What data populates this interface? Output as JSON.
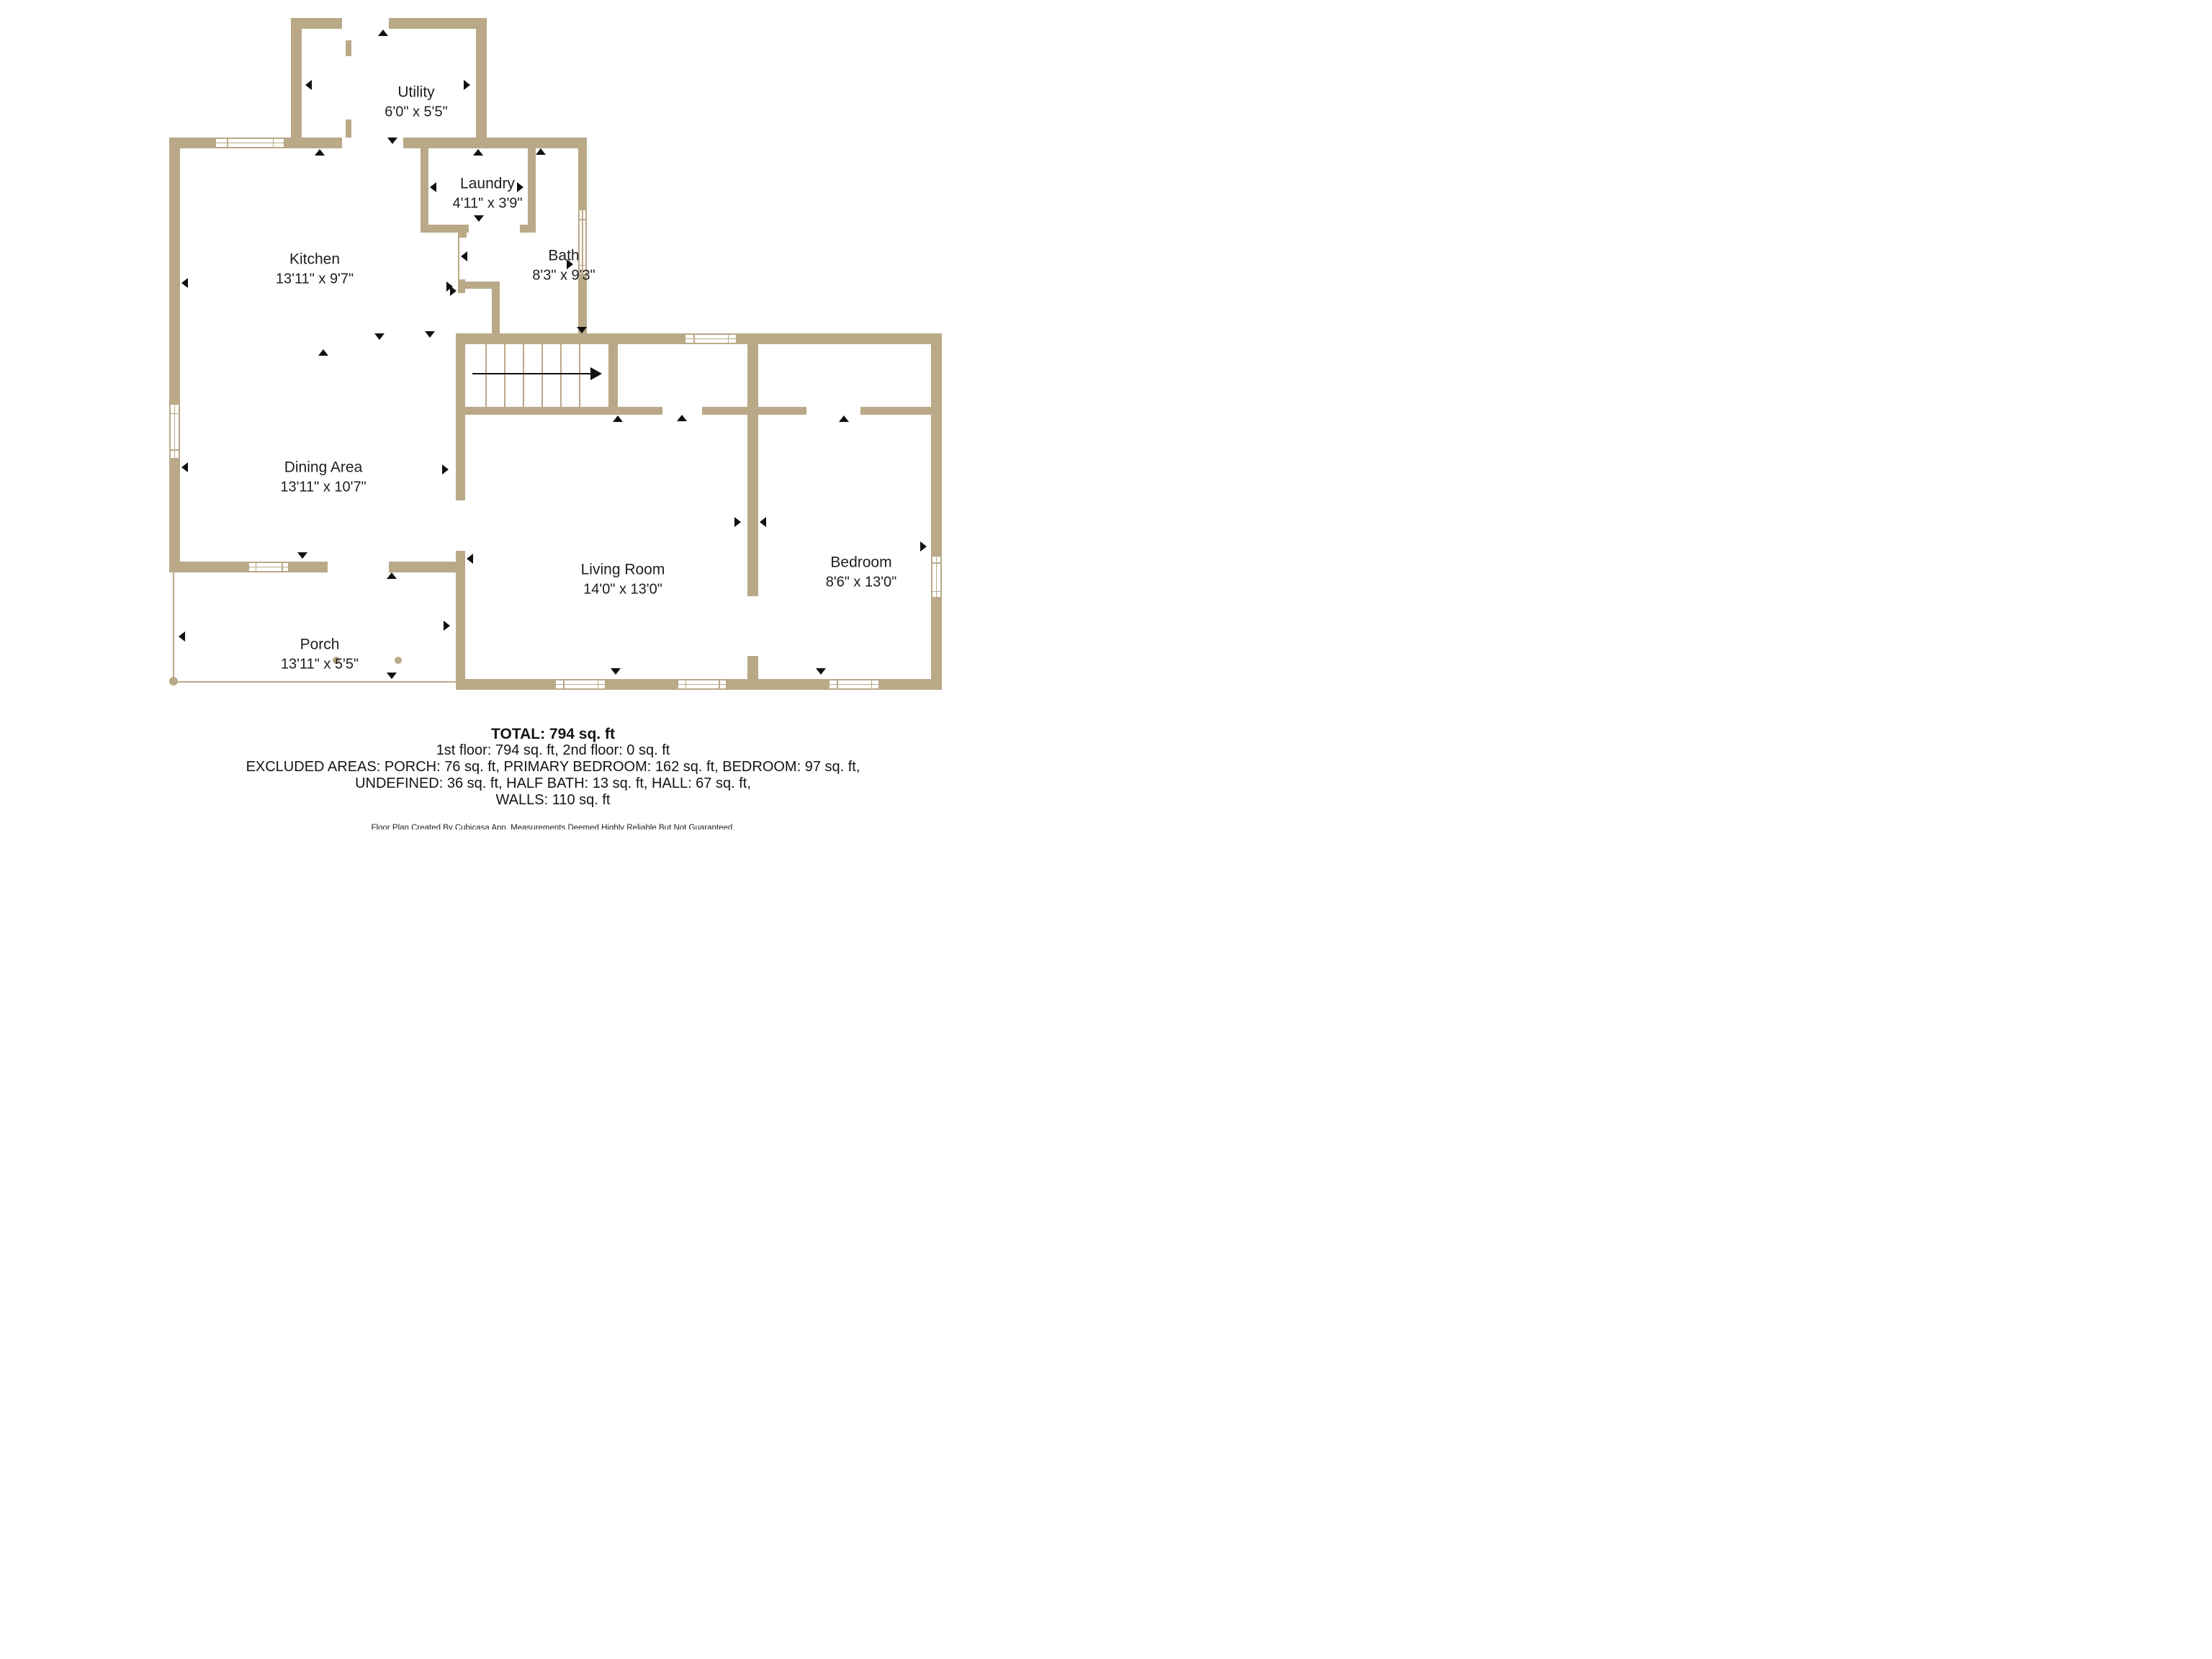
{
  "rooms": {
    "utility": {
      "name": "Utility",
      "dims": "6'0\" x 5'5\""
    },
    "laundry": {
      "name": "Laundry",
      "dims": "4'11\" x 3'9\""
    },
    "kitchen": {
      "name": "Kitchen",
      "dims": "13'11\" x 9'7\""
    },
    "bath": {
      "name": "Bath",
      "dims": "8'3\" x 9'3\""
    },
    "dining": {
      "name": "Dining Area",
      "dims": "13'11\" x 10'7\""
    },
    "living": {
      "name": "Living Room",
      "dims": "14'0\" x 13'0\""
    },
    "bedroom": {
      "name": "Bedroom",
      "dims": "8'6\" x 13'0\""
    },
    "porch": {
      "name": "Porch",
      "dims": "13'11\" x 5'5\""
    }
  },
  "summary": {
    "total": "TOTAL: 794 sq. ft",
    "floors": "1st floor: 794 sq. ft, 2nd floor: 0 sq. ft",
    "excluded_line1": "EXCLUDED AREAS: PORCH: 76 sq. ft, PRIMARY BEDROOM: 162 sq. ft, BEDROOM: 97 sq. ft,",
    "excluded_line2": "UNDEFINED: 36 sq. ft, HALF BATH: 13 sq. ft, HALL: 67 sq. ft,",
    "walls": "WALLS: 110 sq. ft",
    "disclaimer": "Floor Plan Created By Cubicasa App. Measurements Deemed Highly Reliable But Not Guaranteed."
  },
  "colors": {
    "wall": "#b9a987",
    "background": "#ffffff",
    "text": "#1e1e1e",
    "arrow": "#111111"
  }
}
